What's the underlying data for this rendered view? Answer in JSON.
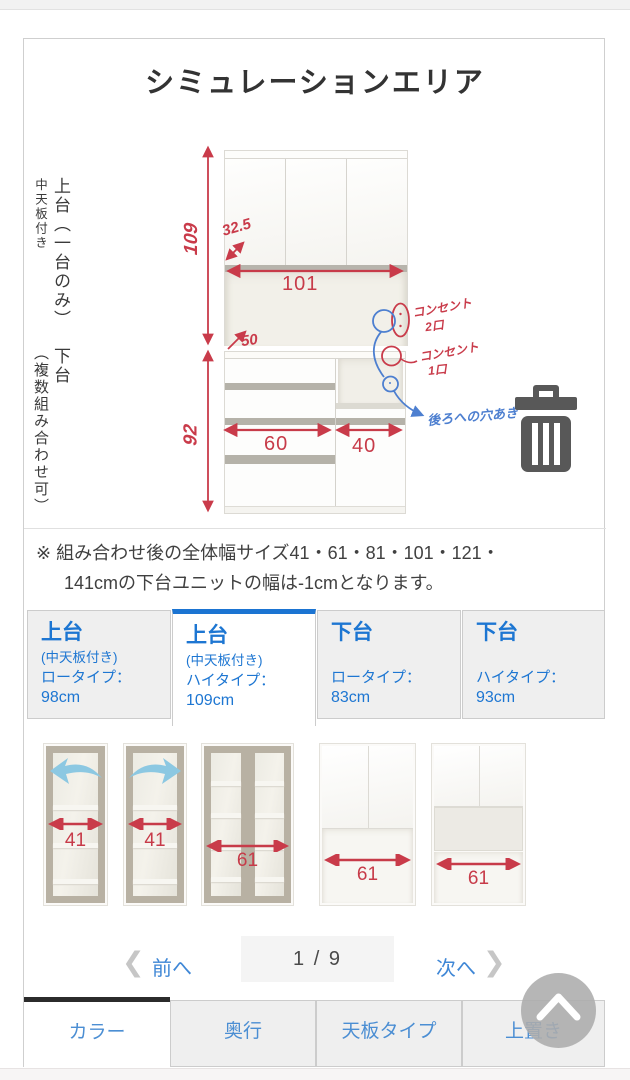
{
  "page_title": "シミュレーションエリア",
  "colors": {
    "size_tab_blue": "#1d76d2",
    "bottom_tab_blue": "#4b8ed3",
    "annotation_red": "#c93b4a",
    "annotation_blue": "#4d7fd0",
    "active_bottom_tab_border": "#2b2b2b",
    "trash_icon_gray": "#585858"
  },
  "diagram": {
    "upper_section_label": "上台（一台のみ）",
    "upper_section_sublabel": "中天板付き",
    "lower_section_label": "下台",
    "lower_section_sublabel": "（複数組み合わせ可）",
    "dimensions": {
      "upper_height": "109",
      "upper_inner_width": "101",
      "upper_door_depth": "32.5",
      "upper_counter_depth": "50",
      "lower_height": "92",
      "lower_left_width": "60",
      "lower_right_width": "40"
    },
    "annotations": {
      "outlet_double_line1": "コンセント",
      "outlet_double_line2": "2口",
      "outlet_single_line1": "コンセント",
      "outlet_single_line2": "1口",
      "back_hole": "後ろへの穴あき"
    }
  },
  "note": {
    "line1": "※ 組み合わせ後の全体幅サイズ41・61・81・101・121・",
    "line2": "141cmの下台ユニットの幅は-1cmとなります。"
  },
  "size_tabs": [
    {
      "title": "上台",
      "subtitle": "(中天板付き)",
      "type_label": "ロータイプ：",
      "height": "98cm"
    },
    {
      "title": "上台",
      "subtitle": "(中天板付き)",
      "type_label": "ハイタイプ：",
      "height": "109cm"
    },
    {
      "title": "下台",
      "subtitle": "",
      "type_label": "ロータイプ：",
      "height": "83cm"
    },
    {
      "title": "下台",
      "subtitle": "",
      "type_label": "ハイタイプ：",
      "height": "93cm"
    }
  ],
  "products": [
    {
      "width_label": "41"
    },
    {
      "width_label": "41"
    },
    {
      "width_label": "61"
    },
    {
      "width_label": "61"
    },
    {
      "width_label": "61"
    }
  ],
  "pagination": {
    "prev_label": "前へ",
    "page_indicator": "1 / 9",
    "next_label": "次へ"
  },
  "bottom_tabs": [
    {
      "label": "カラー"
    },
    {
      "label": "奥行"
    },
    {
      "label": "天板タイプ"
    },
    {
      "label": "上置き"
    }
  ]
}
